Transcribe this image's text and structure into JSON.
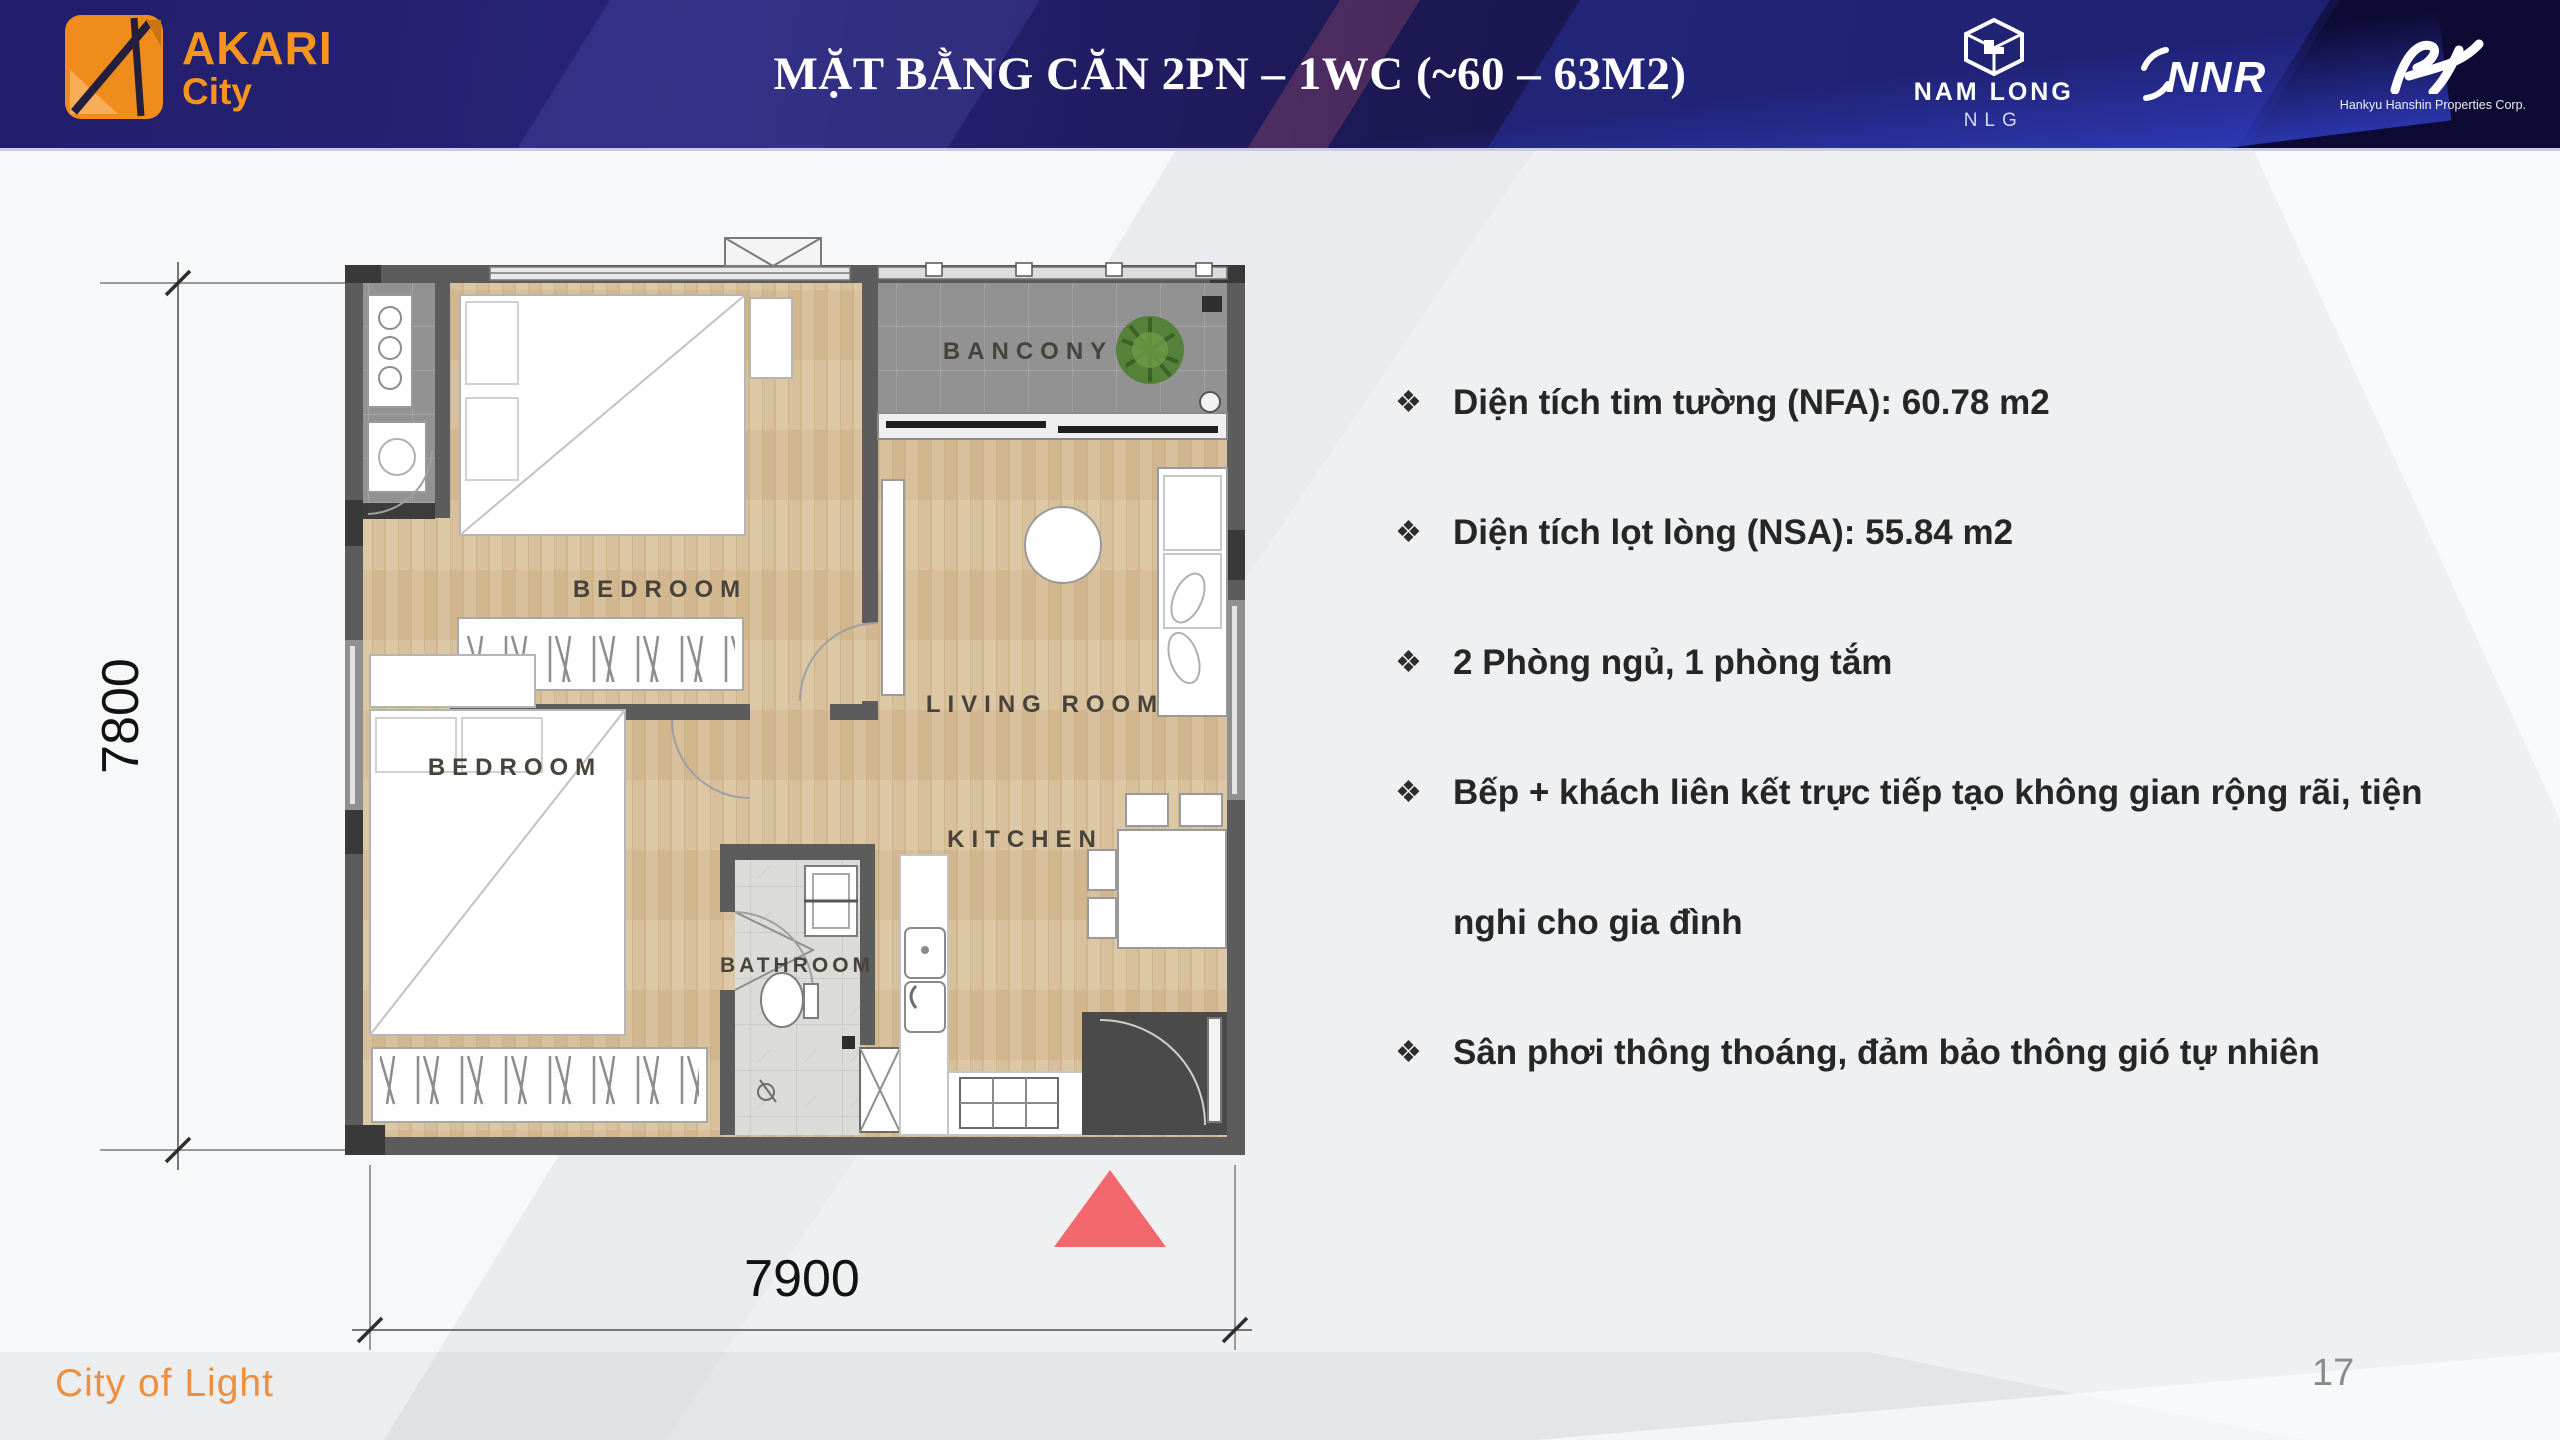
{
  "header": {
    "title": "MẶT BẰNG CĂN 2PN – 1WC (~60 – 63M2)",
    "brand": {
      "name": "AKARI",
      "sub": "City"
    },
    "partners": [
      {
        "name": "NAM LONG",
        "sub": "NLG"
      },
      {
        "name": "NNR"
      },
      {
        "name": "Hankyu Hanshin Properties Corp."
      }
    ]
  },
  "floorplan": {
    "labels": {
      "balcony": "BANCONY",
      "bedroom_top": "BEDROOM",
      "bedroom_bottom": "BEDROOM",
      "living": "LIVING ROOM",
      "bathroom": "BATHROOM",
      "kitchen": "KITCHEN"
    },
    "dimensions": {
      "height": "7800",
      "width": "7900"
    }
  },
  "bullets": {
    "glyph": "❖",
    "items": [
      {
        "text": "Diện tích tim tường (NFA): 60.78 m2"
      },
      {
        "text": "Diện tích lọt lòng (NSA): 55.84 m2"
      },
      {
        "text": "2 Phòng ngủ, 1 phòng tắm"
      },
      {
        "text": "Bếp + khách liên kết trực tiếp tạo không gian rộng rãi, tiện nghi cho gia đình"
      },
      {
        "text": "Sân phơi thông thoáng, đảm bảo thông gió tự nhiên"
      }
    ]
  },
  "footer": {
    "tagline": "City of Light",
    "page_number": "17"
  },
  "colors": {
    "header_navy": "#1e1b60",
    "brand_orange": "#f7941d",
    "triangle_red": "#f2686c",
    "tagline_orange": "#ee8f3f"
  }
}
